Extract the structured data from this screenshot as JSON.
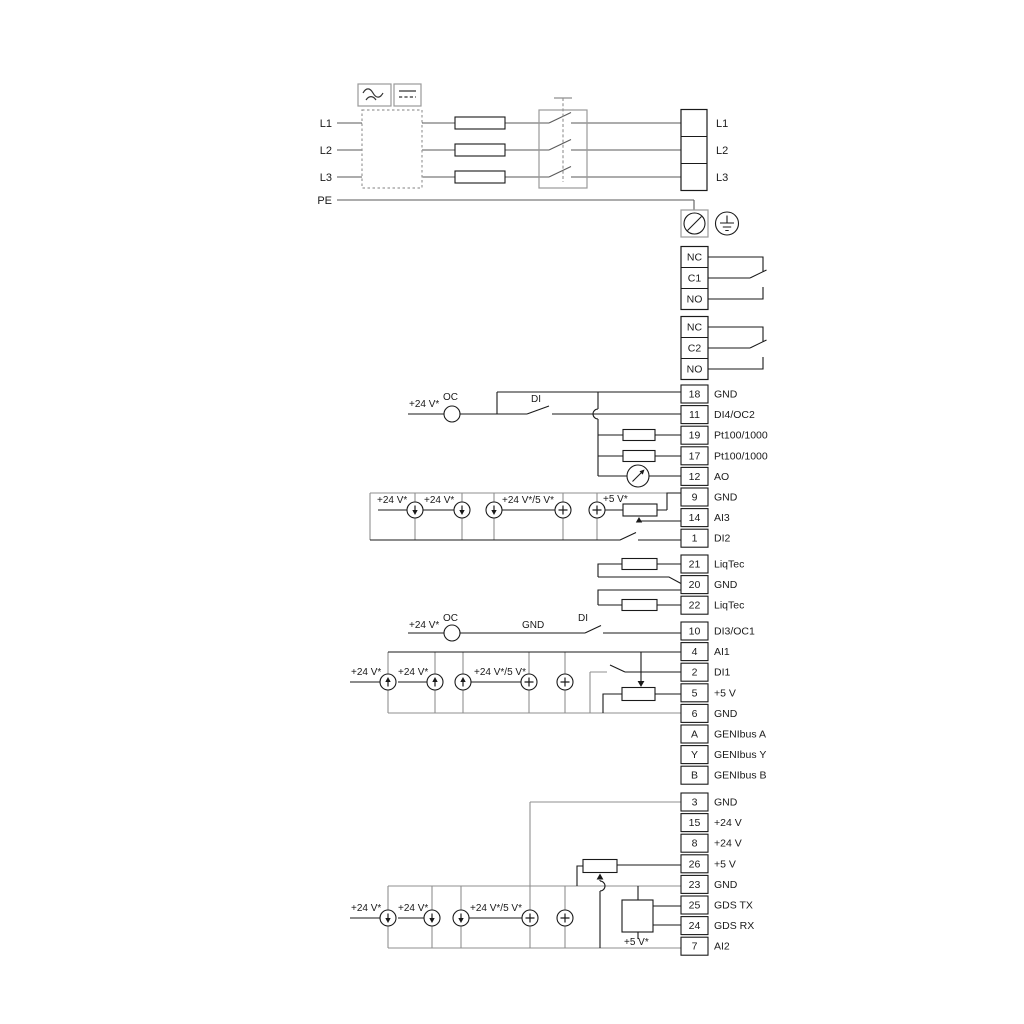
{
  "power": {
    "inputs": [
      "L1",
      "L2",
      "L3",
      "PE"
    ],
    "outputs": [
      "L1",
      "L2",
      "L3"
    ]
  },
  "relays": {
    "relay1": [
      "NC",
      "C1",
      "NO"
    ],
    "relay2": [
      "NC",
      "C2",
      "NO"
    ]
  },
  "terminals": {
    "group1": [
      {
        "num": "18",
        "label": "GND"
      },
      {
        "num": "11",
        "label": "DI4/OC2"
      },
      {
        "num": "19",
        "label": "Pt100/1000"
      },
      {
        "num": "17",
        "label": "Pt100/1000"
      },
      {
        "num": "12",
        "label": "AO"
      },
      {
        "num": "9",
        "label": "GND"
      },
      {
        "num": "14",
        "label": "AI3"
      },
      {
        "num": "1",
        "label": "DI2"
      }
    ],
    "liqtec": [
      {
        "num": "21",
        "label": "LiqTec"
      },
      {
        "num": "20",
        "label": "GND"
      },
      {
        "num": "22",
        "label": "LiqTec"
      }
    ],
    "group2": [
      {
        "num": "10",
        "label": "DI3/OC1"
      },
      {
        "num": "4",
        "label": "AI1"
      },
      {
        "num": "2",
        "label": "DI1"
      },
      {
        "num": "5",
        "label": "+5 V"
      },
      {
        "num": "6",
        "label": "GND"
      },
      {
        "num": "A",
        "label": "GENIbus A"
      },
      {
        "num": "Y",
        "label": "GENIbus Y"
      },
      {
        "num": "B",
        "label": "GENIbus B"
      }
    ],
    "group3": [
      {
        "num": "3",
        "label": "GND"
      },
      {
        "num": "15",
        "label": "+24 V"
      },
      {
        "num": "8",
        "label": "+24 V"
      },
      {
        "num": "26",
        "label": "+5 V"
      },
      {
        "num": "23",
        "label": "GND"
      },
      {
        "num": "25",
        "label": "GDS TX"
      },
      {
        "num": "24",
        "label": "GDS RX"
      },
      {
        "num": "7",
        "label": "AI2"
      }
    ]
  },
  "annotations": {
    "v24": "+24 V*",
    "v24_5": "+24 V*/5 V*",
    "v5": "+5 V*",
    "oc": "OC",
    "di": "DI",
    "gnd": "GND"
  },
  "icons": {
    "ac_box": "ac-wave-icon",
    "dc_box": "dc-line-icon",
    "pe_screw": "screw-terminal-icon",
    "earth": "earth-ground-icon"
  },
  "colors": {
    "wire_gray": "#8f8f8f",
    "wire_black": "#1a1a1a",
    "wire_power": "#5a5a5a"
  }
}
